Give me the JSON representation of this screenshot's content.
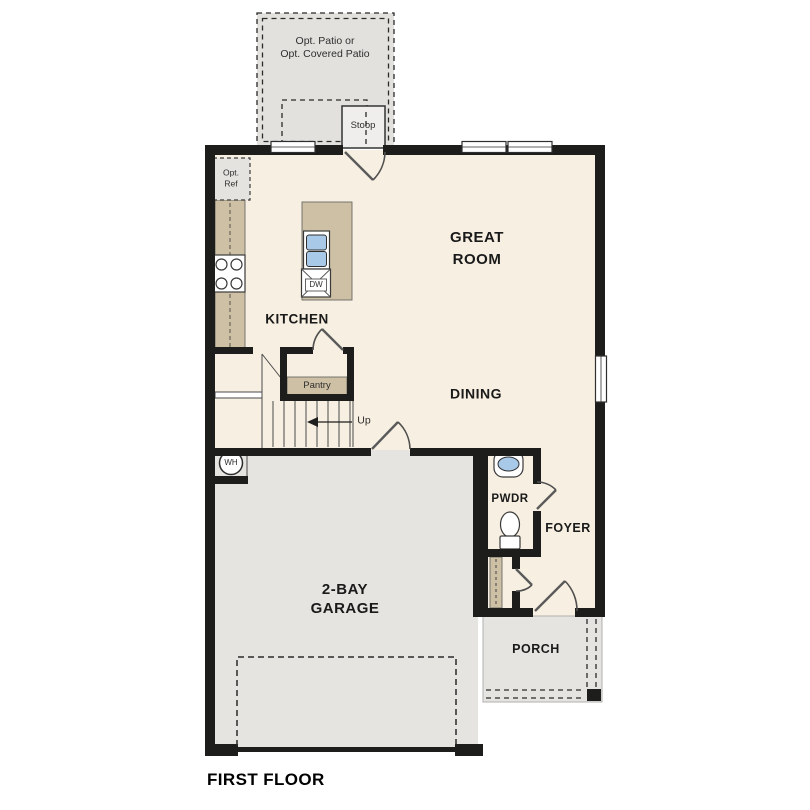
{
  "title": "FIRST FLOOR",
  "colors": {
    "wall": "#1d1d1b",
    "floor": "#f7efe1",
    "concrete": "#e5e4e1",
    "patio": "#e2e1de",
    "cabinet": "#cec0a4",
    "fixture_blue": "#a9c9e8",
    "stoop": "#efeeec",
    "label": "#1a1a1a"
  },
  "rooms": {
    "great_room": "GREAT\nROOM",
    "kitchen": "KITCHEN",
    "dining": "DINING",
    "garage": "2-BAY\nGARAGE",
    "pwdr": "PWDR",
    "foyer": "FOYER",
    "porch": "PORCH"
  },
  "annotations": {
    "opt_patio": "Opt. Patio or\nOpt. Covered Patio",
    "stoop": "Stoop",
    "opt_ref": "Opt.\nRef",
    "pantry": "Pantry",
    "up": "Up",
    "dw": "DW",
    "wh": "WH"
  }
}
